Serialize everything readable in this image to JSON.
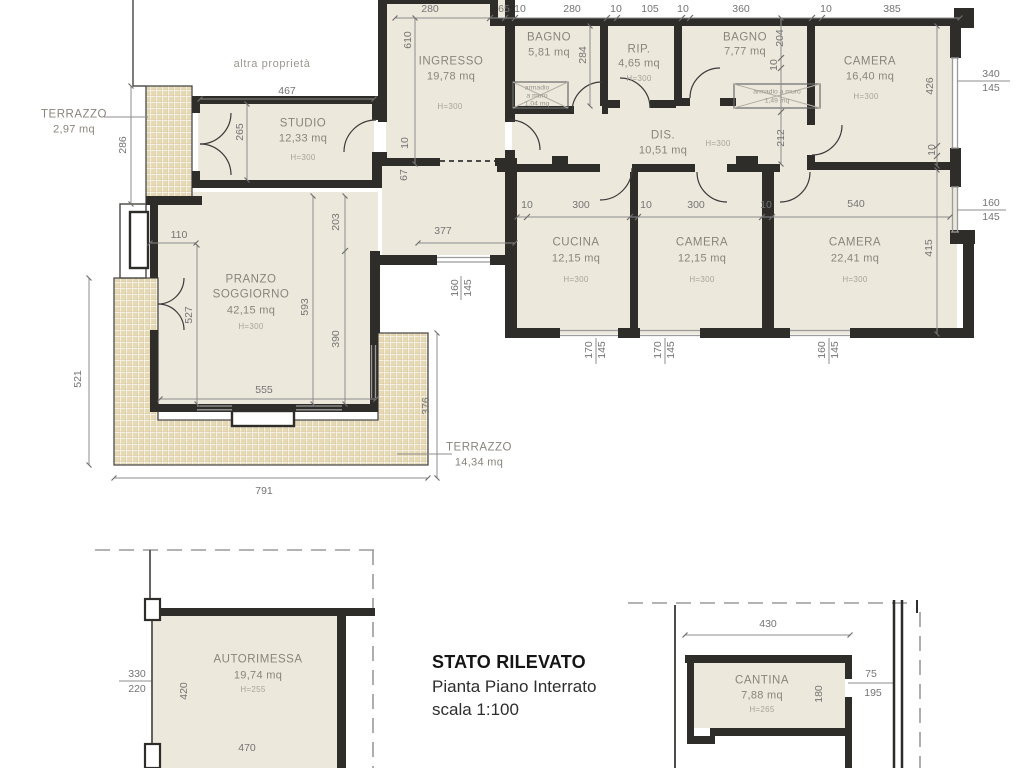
{
  "title_block": {
    "line1": "STATO RILEVATO",
    "line2": "Pianta Piano Interrato",
    "line3": "scala 1:100"
  },
  "annotations": {
    "other_property": "altra proprietà"
  },
  "colors": {
    "wall": "#2f2d2a",
    "room_fill": "#ede8dc",
    "terrace_tile": "#e5d9b6",
    "tile_grout": "#ffffff",
    "thin_line": "#8c8c8c",
    "dim_text": "#747474",
    "room_text": "#8a857c",
    "height_text": "#a9a49a",
    "title_text": "#151515"
  },
  "rooms": [
    {
      "name": "TERRAZZO",
      "area": "2,97 mq",
      "x": 74,
      "ny": 115,
      "ay": 130
    },
    {
      "name": "STUDIO",
      "area": "12,33 mq",
      "height": "H=300",
      "x": 303,
      "ny": 124,
      "ay": 139,
      "hy": 158
    },
    {
      "name": "INGRESSO",
      "area": "19,78 mq",
      "height": "H=300",
      "x": 451,
      "ny": 62,
      "ay": 77,
      "hx": 450,
      "hy": 107
    },
    {
      "name": "BAGNO",
      "area": "5,81 mq",
      "x": 549,
      "ny": 38,
      "ay": 53
    },
    {
      "name": "RIP.",
      "area": "4,65 mq",
      "height": "H=300",
      "x": 639,
      "ny": 50,
      "ay": 64,
      "hy": 79
    },
    {
      "name": "BAGNO",
      "area": "7,77 mq",
      "x": 745,
      "ny": 38,
      "ay": 52
    },
    {
      "name": "CAMERA",
      "area": "16,40 mq",
      "height": "H=300",
      "x": 870,
      "ny": 62,
      "ay": 77,
      "hx": 866,
      "hy": 97
    },
    {
      "name": "DIS.",
      "area": "10,51 mq",
      "height": "H=300",
      "x": 663,
      "ny": 136,
      "ay": 151,
      "hx": 718,
      "hy": 144
    },
    {
      "name": "CUCINA",
      "area": "12,15 mq",
      "height": "H=300",
      "x": 576,
      "ny": 243,
      "ay": 259,
      "hy": 280
    },
    {
      "name": "CAMERA",
      "area": "12,15 mq",
      "height": "H=300",
      "x": 702,
      "ny": 243,
      "ay": 259,
      "hy": 280
    },
    {
      "name": "CAMERA",
      "area": "22,41 mq",
      "height": "H=300",
      "x": 855,
      "ny": 243,
      "ay": 259,
      "hy": 280
    },
    {
      "name": "PRANZO",
      "name2": "SOGGIORNO",
      "area": "42,15 mq",
      "height": "H=300",
      "x": 251,
      "ny": 280,
      "ny2": 295,
      "ay": 311,
      "hy": 327
    },
    {
      "name": "TERRAZZO",
      "area": "14,34 mq",
      "x": 479,
      "ny": 448,
      "ay": 463
    },
    {
      "name": "AUTORIMESSA",
      "area": "19,74 mq",
      "height": "H=255",
      "x": 258,
      "ny": 660,
      "ay": 676,
      "hx": 253,
      "hy": 690
    },
    {
      "name": "CANTINA",
      "area": "7,88 mq",
      "height": "H=265",
      "x": 762,
      "ny": 681,
      "ay": 696,
      "hy": 710
    }
  ],
  "closets": [
    {
      "lines": [
        "armadio",
        "a muro",
        "1,04 mq"
      ],
      "x": 537,
      "y": 89,
      "lh": 8
    },
    {
      "lines": [
        "armadio a muro",
        "1,49 mq"
      ],
      "x": 777,
      "y": 93,
      "lh": 9
    }
  ],
  "dimensions": [
    {
      "t": "280",
      "x": 430,
      "y": 9
    },
    {
      "t": "65",
      "x": 504,
      "y": 9
    },
    {
      "t": "10",
      "x": 520,
      "y": 9
    },
    {
      "t": "280",
      "x": 572,
      "y": 9
    },
    {
      "t": "10",
      "x": 616,
      "y": 9
    },
    {
      "t": "105",
      "x": 650,
      "y": 9
    },
    {
      "t": "10",
      "x": 683,
      "y": 9
    },
    {
      "t": "360",
      "x": 741,
      "y": 9
    },
    {
      "t": "10",
      "x": 826,
      "y": 9
    },
    {
      "t": "385",
      "x": 892,
      "y": 9
    },
    {
      "t": "467",
      "x": 287,
      "y": 91
    },
    {
      "t": "610",
      "x": 408,
      "y": 40,
      "r": 1
    },
    {
      "t": "10",
      "x": 405,
      "y": 143,
      "r": 1
    },
    {
      "t": "67",
      "x": 404,
      "y": 175,
      "r": 1
    },
    {
      "t": "286",
      "x": 123,
      "y": 145,
      "r": 1
    },
    {
      "t": "265",
      "x": 240,
      "y": 132,
      "r": 1
    },
    {
      "t": "284",
      "x": 583,
      "y": 55,
      "r": 1
    },
    {
      "t": "204",
      "x": 780,
      "y": 38,
      "r": 1
    },
    {
      "t": "10",
      "x": 774,
      "y": 65,
      "r": 1
    },
    {
      "t": "212",
      "x": 781,
      "y": 138,
      "r": 1
    },
    {
      "t": "426",
      "x": 930,
      "y": 86,
      "r": 1
    },
    {
      "t": "10",
      "x": 932,
      "y": 150,
      "r": 1
    },
    {
      "t": "415",
      "x": 929,
      "y": 248,
      "r": 1
    },
    {
      "t": "340",
      "x": 991,
      "y": 74
    },
    {
      "t": "145",
      "x": 991,
      "y": 88
    },
    {
      "t": "160",
      "x": 991,
      "y": 203
    },
    {
      "t": "145",
      "x": 991,
      "y": 217
    },
    {
      "t": "110",
      "x": 179,
      "y": 235
    },
    {
      "t": "203",
      "x": 336,
      "y": 222,
      "r": 1
    },
    {
      "t": "377",
      "x": 443,
      "y": 231
    },
    {
      "t": "10",
      "x": 527,
      "y": 205
    },
    {
      "t": "300",
      "x": 581,
      "y": 205
    },
    {
      "t": "10",
      "x": 646,
      "y": 205
    },
    {
      "t": "300",
      "x": 696,
      "y": 205
    },
    {
      "t": "10",
      "x": 766,
      "y": 205
    },
    {
      "t": "540",
      "x": 856,
      "y": 204
    },
    {
      "t": "160",
      "x": 455,
      "y": 288,
      "r": 1
    },
    {
      "t": "145",
      "x": 468,
      "y": 288,
      "r": 1
    },
    {
      "t": "527",
      "x": 189,
      "y": 315,
      "r": 1
    },
    {
      "t": "593",
      "x": 305,
      "y": 307,
      "r": 1
    },
    {
      "t": "390",
      "x": 336,
      "y": 339,
      "r": 1
    },
    {
      "t": "555",
      "x": 264,
      "y": 390
    },
    {
      "t": "521",
      "x": 78,
      "y": 379,
      "r": 1
    },
    {
      "t": "376",
      "x": 426,
      "y": 406,
      "r": 1
    },
    {
      "t": "791",
      "x": 264,
      "y": 491
    },
    {
      "t": "170",
      "x": 589,
      "y": 350,
      "r": 1
    },
    {
      "t": "145",
      "x": 602,
      "y": 350,
      "r": 1
    },
    {
      "t": "170",
      "x": 658,
      "y": 350,
      "r": 1
    },
    {
      "t": "145",
      "x": 671,
      "y": 350,
      "r": 1
    },
    {
      "t": "160",
      "x": 822,
      "y": 350,
      "r": 1
    },
    {
      "t": "145",
      "x": 835,
      "y": 350,
      "r": 1
    },
    {
      "t": "330",
      "x": 137,
      "y": 674
    },
    {
      "t": "220",
      "x": 137,
      "y": 689
    },
    {
      "t": "420",
      "x": 184,
      "y": 691,
      "r": 1
    },
    {
      "t": "470",
      "x": 247,
      "y": 748
    },
    {
      "t": "430",
      "x": 768,
      "y": 624
    },
    {
      "t": "180",
      "x": 819,
      "y": 694,
      "r": 1
    },
    {
      "t": "75",
      "x": 871,
      "y": 674
    },
    {
      "t": "195",
      "x": 873,
      "y": 693
    }
  ]
}
